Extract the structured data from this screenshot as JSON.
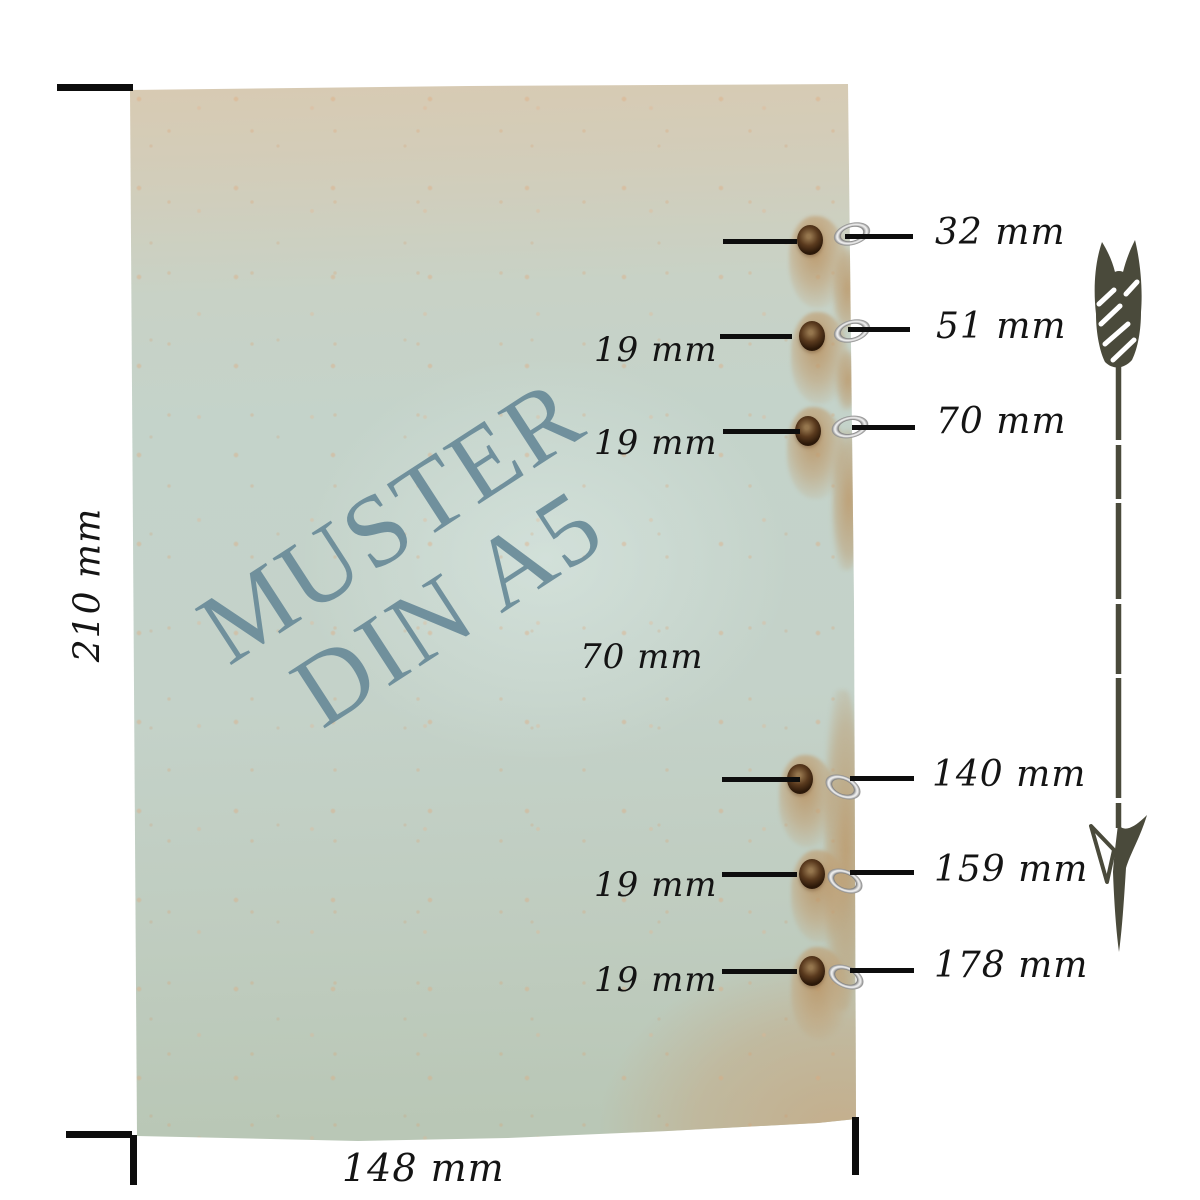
{
  "diagram": {
    "watermark": {
      "line1": "MUSTER",
      "line2": "DIN A5"
    },
    "height_label": "210 mm",
    "width_label": "148 mm",
    "holes": [
      {
        "position_label": "32 mm"
      },
      {
        "position_label": "51 mm"
      },
      {
        "position_label": "70 mm"
      },
      {
        "position_label": "140 mm"
      },
      {
        "position_label": "159 mm"
      },
      {
        "position_label": "178 mm"
      }
    ],
    "spacing_labels": [
      "19 mm",
      "19 mm",
      "70 mm",
      "19 mm",
      "19 mm"
    ],
    "colors": {
      "paper_teal": "#c4d3ca",
      "paper_beige": "#d8cab2",
      "paper_tan": "#c7b291",
      "watermark_blue": "#688a98",
      "line_black": "#0d0d0d",
      "arrow_olive": "#4a4a3b",
      "ring_silver": "#d9d9d9",
      "hole_brown": "#5a3a1e"
    },
    "icons": {
      "arrow": "down-arrow-decorative"
    }
  }
}
